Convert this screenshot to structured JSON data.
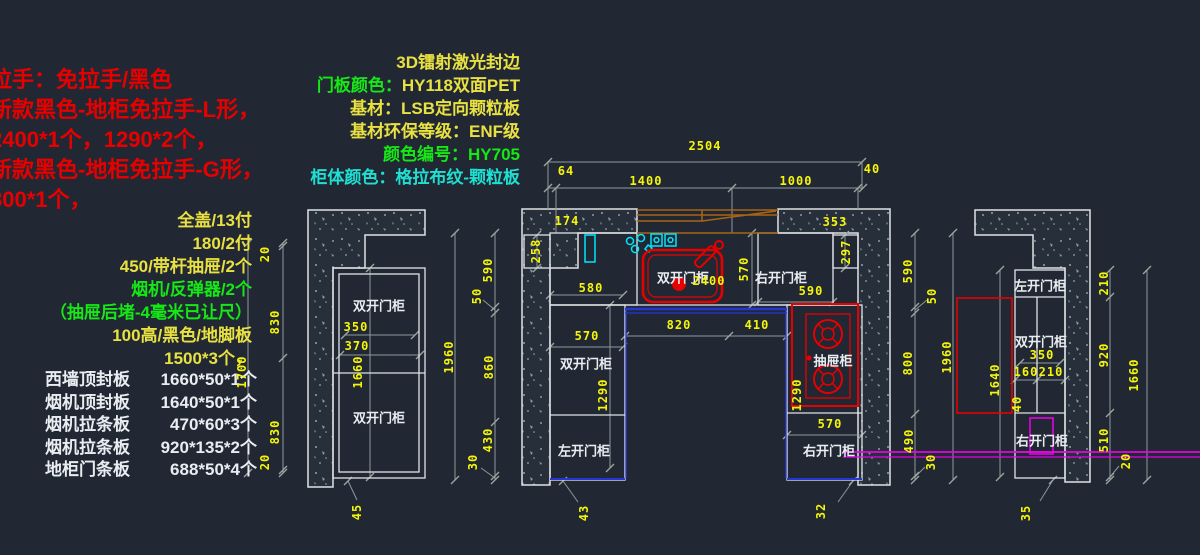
{
  "red_notes": {
    "l1": "拉手：免拉手/黑色",
    "l2": "新款黑色-地柜免拉手-L形，",
    "l3": "2400*1个，1290*2个，",
    "l4": "新款黑色-地柜免拉手-G形，",
    "l5": "800*1个，"
  },
  "spec_notes": {
    "l1": "3D镭射激光封边",
    "l2_label": "门板颜色：",
    "l2_value": "HY118双面PET",
    "l3": "基材：LSB定向颗粒板",
    "l4": "基材环保等级：ENF级",
    "l5": "颜色编号：HY705",
    "l6_label": "柜体颜色：",
    "l6_value": "格拉布纹-颗粒板"
  },
  "hardware_notes": {
    "l1": "全盖/13付",
    "l2": "180/2付",
    "l3": "450/带杆抽屉/2个",
    "l4": "烟机/反弹器/2个",
    "l5": "（抽屉后堵-4毫米已让尺）",
    "l6": "100高/黑色/地脚板",
    "l7": "1500*3个，"
  },
  "panel_list": {
    "r1_name": "西墙顶封板",
    "r1_spec": "1660*50*1个",
    "r2_name": "烟机顶封板",
    "r2_spec": "1640*50*1个",
    "r3_name": "烟机拉条板",
    "r3_spec": "470*60*3个",
    "r4_name": "烟机拉条板",
    "r4_spec": "920*135*2个",
    "r5_name": "地柜门条板",
    "r5_spec": "688*50*4个"
  },
  "left_elev": {
    "cab_top": "双开门柜",
    "cab_bottom": "双开门柜",
    "d350": "350",
    "d370": "370",
    "d1660": "1660",
    "d20_top": "20",
    "d830_a": "830",
    "d830_b": "830",
    "d20_bottom": "20",
    "d1700": "1700",
    "d45": "45"
  },
  "center_elev": {
    "d2504": "2504",
    "d64": "64",
    "d1400": "1400",
    "d1000": "1000",
    "d40": "40",
    "d174": "174",
    "d353": "353",
    "d258": "258",
    "d580": "580",
    "d2400": "2400",
    "cab_sink": "双开门柜",
    "cab_top_right": "右开门柜",
    "d570_top": "570",
    "d590_top": "590",
    "d297": "297",
    "d820": "820",
    "d410": "410",
    "d570_left": "570",
    "cab_mid_left": "双开门柜",
    "d1290_left": "1290",
    "cab_bottom_left": "左开门柜",
    "d43": "43",
    "cab_drawer": "抽屉柜",
    "d1290_right": "1290",
    "d570_right": "570",
    "cab_bottom_right": "右开门柜",
    "d32": "32",
    "lchain": {
      "d1960": "1960",
      "d590": "590",
      "d50": "50",
      "d860": "860",
      "d430": "430",
      "d30": "30"
    },
    "rchain": {
      "d1960": "1960",
      "d590": "590",
      "d50": "50",
      "d800": "800",
      "d490": "490",
      "d30": "30"
    }
  },
  "right_elev": {
    "cab_top": "左开门柜",
    "cab_mid": "双开门柜",
    "cab_bottom": "右开门柜",
    "d350": "350",
    "d160": "160",
    "d210": "210",
    "d40": "40",
    "d1640": "1640",
    "d35": "35",
    "chain": {
      "d210": "210",
      "d920": "920",
      "d510": "510",
      "d20": "20",
      "d1660": "1660"
    }
  },
  "colors": {
    "background": "#212833",
    "dim_text": "#f5f50a",
    "label_text": "#e9edf1",
    "note_red": "#e60000",
    "note_green": "#16e816",
    "note_yellow": "#e8e141",
    "note_cyan": "#1ee0d2",
    "wall_outline": "#dfe3e6",
    "dim_line": "#8e979e",
    "soffit_orange": "#a86414",
    "counter_blue": "#2436d4",
    "symbol_cyan": "#00e5ff",
    "symbol_red": "#e60000",
    "accent_magenta": "#e800e8"
  }
}
